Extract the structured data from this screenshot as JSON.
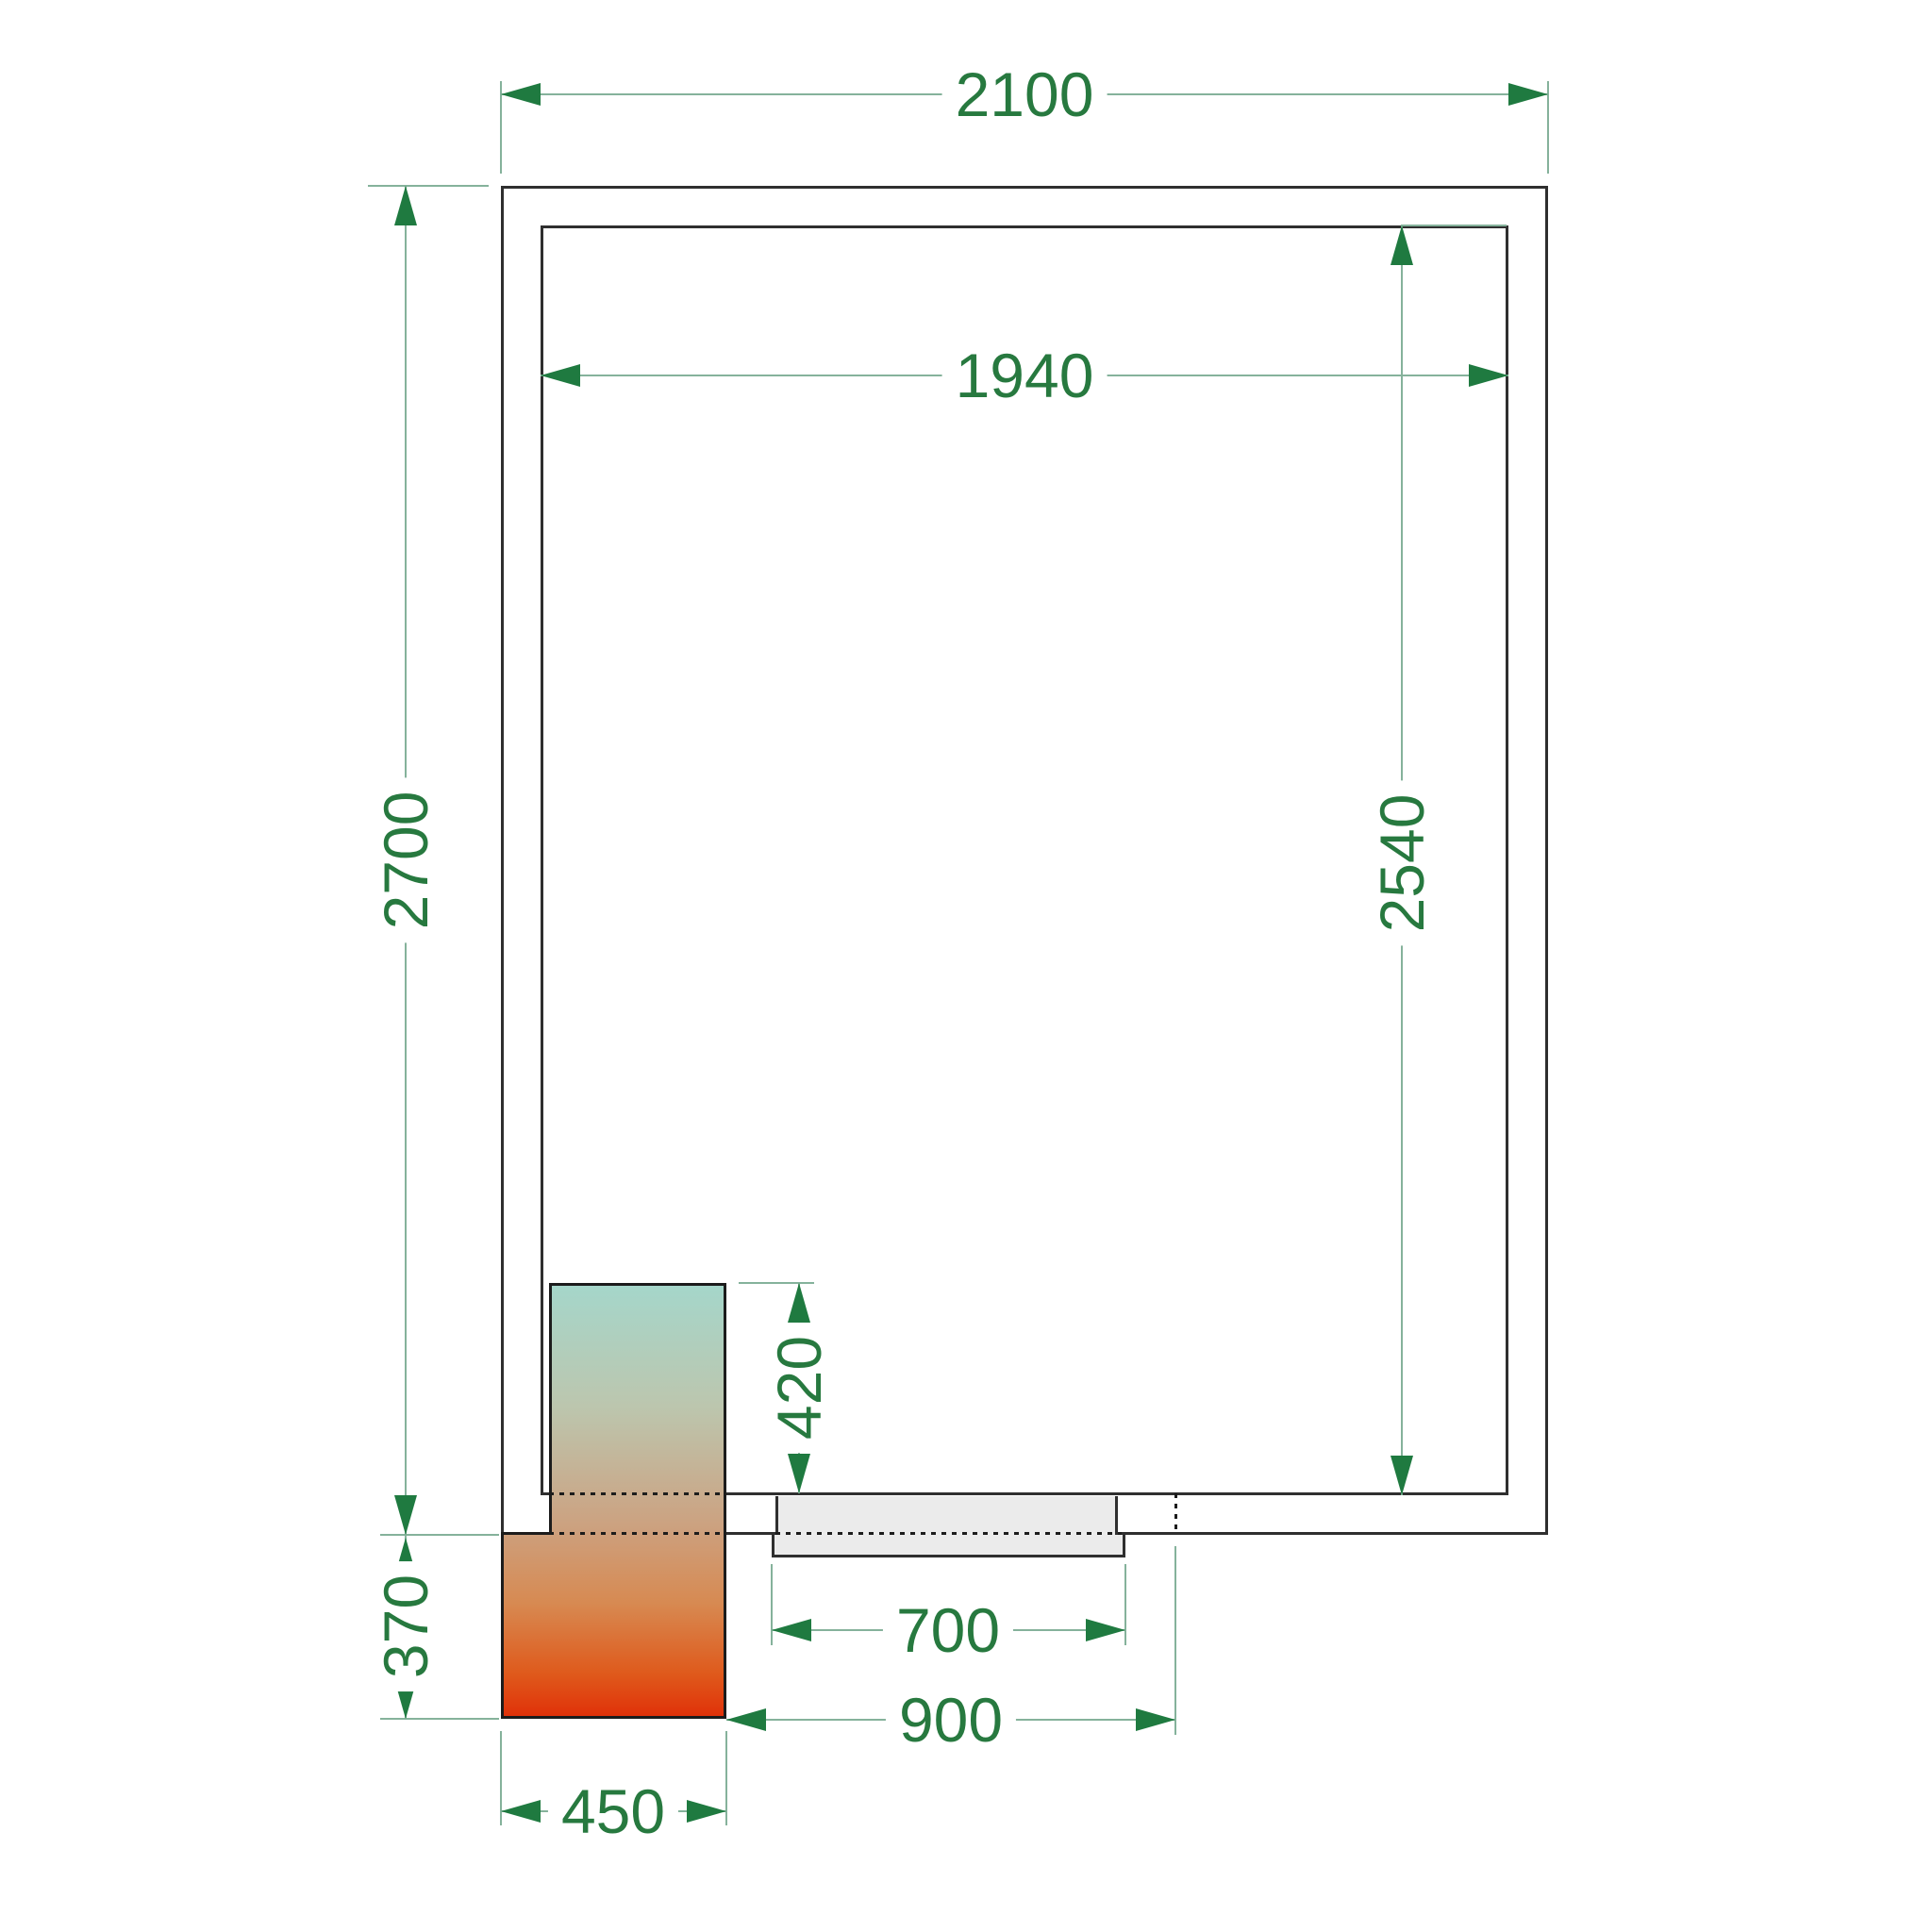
{
  "dims": {
    "outer_width": "2100",
    "inner_width": "1940",
    "outer_height": "2700",
    "inner_height": "2540",
    "unit_inset_depth": "420",
    "unit_outside_depth": "370",
    "unit_width": "450",
    "door_width": "700",
    "opening_width": "900"
  },
  "colors": {
    "wall_line": "#2f2f2f",
    "dimension_line": "#85b29b",
    "dimension_text": "#27793f",
    "arrowhead": "#1f7a40",
    "door_fill": "#ebebeb",
    "unit_gradient_top": "#a5d6ca",
    "unit_gradient_tan": "#c9a98a",
    "unit_gradient_orange": "#d78a52",
    "unit_gradient_bottom": "#e02f08",
    "background": "#ffffff"
  }
}
